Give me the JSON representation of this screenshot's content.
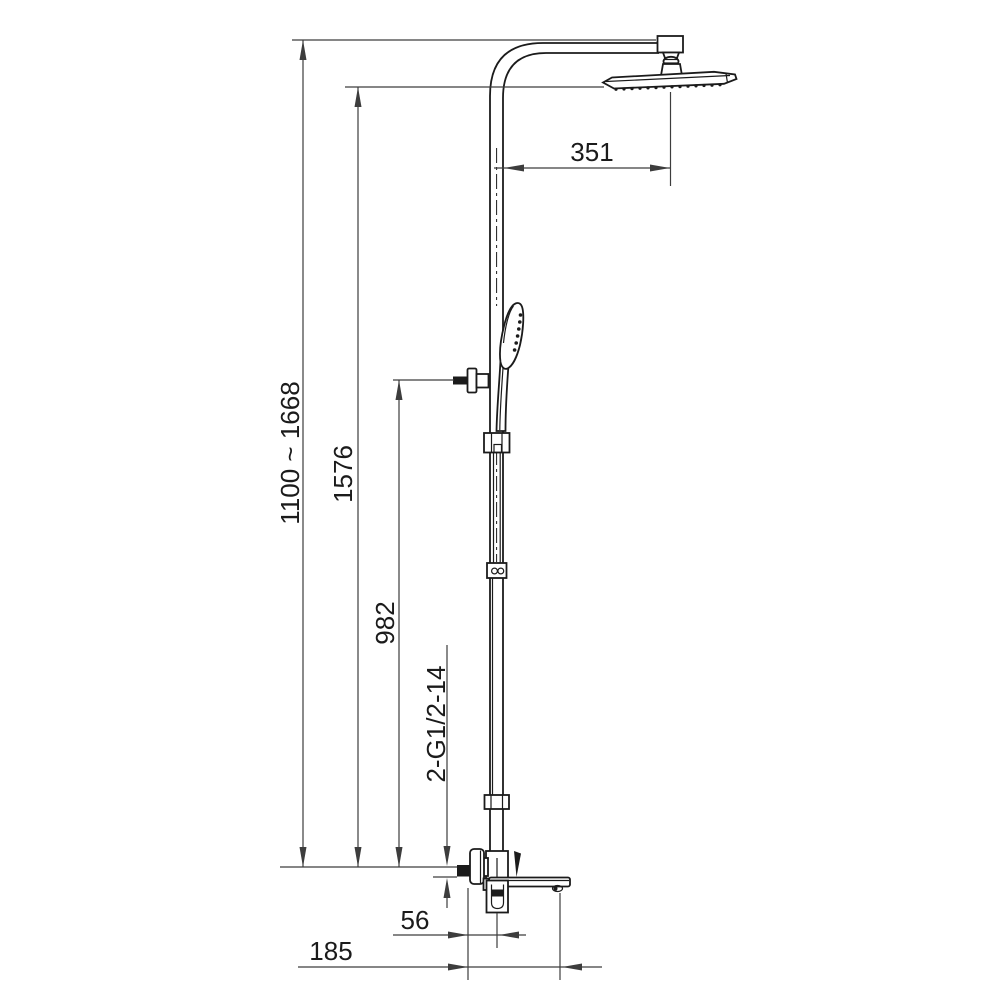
{
  "drawing": {
    "type": "technical-dimension-drawing",
    "subject": "thermostatic shower column with overhead shower, hand shower and tub spout mixer",
    "labels": {
      "overall_height": "1100 ~ 1668",
      "head_face_height": "1576",
      "holder_height": "982",
      "inlet_thread": "2-G1/2-14",
      "arm_reach": "351",
      "spout_center": "56",
      "spout_reach": "185"
    },
    "colors": {
      "line": "#1b1b1b",
      "dimension": "#3d3d3d",
      "background": "#ffffff"
    }
  }
}
